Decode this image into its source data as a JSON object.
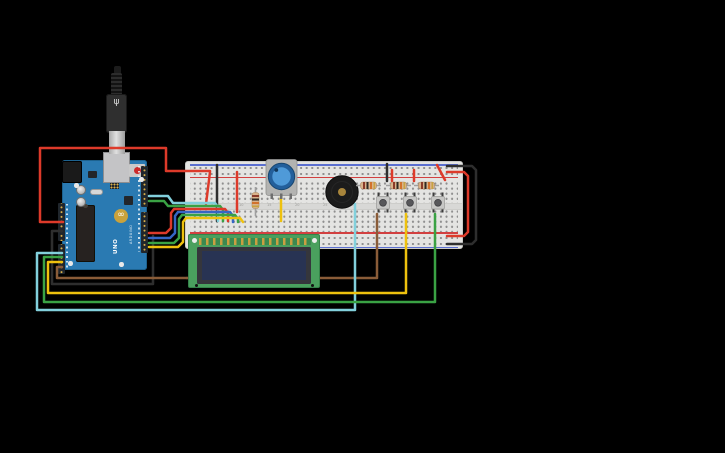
{
  "canvas": {
    "width": 725,
    "height": 453,
    "background": "#000000"
  },
  "palette": {
    "red": "#dd3a2a",
    "black": "#2e2e2e",
    "yellow": "#eec10e",
    "green": "#3aa244",
    "cyan": "#82d0dc",
    "blue": "#3566c4",
    "brown": "#8a5c38"
  },
  "arduino": {
    "label": "Arduino Uno R3",
    "logo": "∞",
    "brand": "ARDUINO",
    "model": "UNO"
  },
  "usb_symbol": "ψ",
  "breadboard": {
    "label": "Breadboard",
    "column_labels": [
      "5",
      "10",
      "15",
      "20",
      "25",
      "30",
      "35",
      "40",
      "45"
    ]
  },
  "lcd": {
    "label": "LCD 16x2"
  },
  "components": {
    "buzzer": "Piezo buzzer",
    "potentiometer": "Potentiometer",
    "buttons": [
      "Pushbutton 1",
      "Pushbutton 2",
      "Pushbutton 3"
    ],
    "resistors": [
      "Resistor 1",
      "Resistor 2",
      "Resistor 3",
      "Resistor 4"
    ],
    "usb_cable": "USB cable"
  },
  "wires": [
    {
      "name": "wire-5v-red",
      "color": "red",
      "layer": "over",
      "points": [
        [
          63,
          222
        ],
        [
          40,
          222
        ],
        [
          40,
          148
        ],
        [
          166,
          148
        ],
        [
          166,
          171
        ],
        [
          210,
          171
        ]
      ]
    },
    {
      "name": "wire-red-jumper-left-diagonal",
      "color": "red",
      "layer": "over",
      "points": [
        [
          210,
          172
        ],
        [
          206,
          204
        ]
      ]
    },
    {
      "name": "wire-red-jumper-col9",
      "color": "red",
      "layer": "over",
      "points": [
        [
          237,
          172
        ],
        [
          237,
          212
        ]
      ]
    },
    {
      "name": "wire-black-jumper-col5",
      "color": "black",
      "layer": "over",
      "points": [
        [
          217,
          165
        ],
        [
          217,
          221
        ]
      ]
    },
    {
      "name": "wire-gnd-black",
      "color": "black",
      "layer": "over",
      "points": [
        [
          62,
          231
        ],
        [
          52,
          231
        ],
        [
          52,
          284
        ],
        [
          153,
          284
        ],
        [
          153,
          236
        ]
      ]
    },
    {
      "name": "wire-cyan-a1-buzzer",
      "color": "cyan",
      "layer": "over",
      "points": [
        [
          62,
          253
        ],
        [
          37,
          253
        ],
        [
          37,
          310
        ],
        [
          355,
          310
        ],
        [
          355,
          204
        ]
      ]
    },
    {
      "name": "wire-green-a2-button3",
      "color": "green",
      "layer": "over",
      "points": [
        [
          62,
          257
        ],
        [
          44,
          257
        ],
        [
          44,
          302
        ],
        [
          435,
          302
        ],
        [
          435,
          214
        ]
      ]
    },
    {
      "name": "wire-yellow-a3-button2",
      "color": "yellow",
      "layer": "over",
      "points": [
        [
          62,
          262
        ],
        [
          48,
          262
        ],
        [
          48,
          293
        ],
        [
          406,
          293
        ],
        [
          406,
          214
        ]
      ]
    },
    {
      "name": "wire-brown-a4-segment-left",
      "color": "brown",
      "layer": "over",
      "points": [
        [
          62,
          267
        ],
        [
          57,
          267
        ],
        [
          57,
          278
        ],
        [
          187,
          278
        ]
      ]
    },
    {
      "name": "wire-brown-a4-segment-right",
      "color": "brown",
      "layer": "under",
      "points": [
        [
          187,
          278
        ],
        [
          377,
          278
        ],
        [
          377,
          214
        ]
      ]
    },
    {
      "name": "wire-d9-cyan",
      "color": "cyan",
      "layer": "over",
      "points": [
        [
          149,
          196
        ],
        [
          168,
          196
        ],
        [
          173,
          203
        ],
        [
          215,
          203
        ],
        [
          218,
          207
        ],
        [
          218,
          221
        ]
      ]
    },
    {
      "name": "wire-d8-green",
      "color": "green",
      "layer": "over",
      "points": [
        [
          149,
          201
        ],
        [
          164,
          201
        ],
        [
          168,
          206
        ],
        [
          220,
          206
        ],
        [
          223,
          210
        ],
        [
          223,
          221
        ]
      ]
    },
    {
      "name": "wire-d3-red",
      "color": "red",
      "layer": "over",
      "points": [
        [
          149,
          233
        ],
        [
          166,
          233
        ],
        [
          171,
          228
        ],
        [
          171,
          213
        ],
        [
          174,
          209
        ],
        [
          225,
          209
        ],
        [
          228,
          213
        ],
        [
          228,
          221
        ]
      ]
    },
    {
      "name": "wire-d2-blue",
      "color": "blue",
      "layer": "over",
      "points": [
        [
          149,
          238
        ],
        [
          170,
          238
        ],
        [
          175,
          233
        ],
        [
          175,
          216
        ],
        [
          178,
          212
        ],
        [
          230,
          212
        ],
        [
          233,
          216
        ],
        [
          233,
          222
        ]
      ]
    },
    {
      "name": "wire-d1-green",
      "color": "green",
      "layer": "over",
      "points": [
        [
          149,
          243
        ],
        [
          174,
          243
        ],
        [
          179,
          238
        ],
        [
          179,
          219
        ],
        [
          182,
          215
        ],
        [
          235,
          215
        ],
        [
          238,
          219
        ],
        [
          238,
          222
        ]
      ]
    },
    {
      "name": "wire-d0-yellow",
      "color": "yellow",
      "layer": "over",
      "points": [
        [
          149,
          247
        ],
        [
          178,
          247
        ],
        [
          183,
          242
        ],
        [
          183,
          222
        ],
        [
          186,
          218
        ],
        [
          240,
          218
        ],
        [
          243,
          222
        ]
      ]
    },
    {
      "name": "wire-pot-yellow",
      "color": "yellow",
      "layer": "over",
      "points": [
        [
          281,
          197
        ],
        [
          281,
          221
        ]
      ]
    },
    {
      "name": "wire-rail-red-right",
      "color": "red",
      "layer": "over",
      "points": [
        [
          447,
          172
        ],
        [
          464,
          172
        ],
        [
          468,
          176
        ],
        [
          468,
          232
        ],
        [
          464,
          236
        ],
        [
          447,
          236
        ]
      ]
    },
    {
      "name": "wire-rail-black-right",
      "color": "black",
      "layer": "over",
      "points": [
        [
          447,
          166
        ],
        [
          472,
          166
        ],
        [
          476,
          170
        ],
        [
          476,
          240
        ],
        [
          472,
          244
        ],
        [
          447,
          244
        ]
      ]
    },
    {
      "name": "wire-red-button1",
      "color": "red",
      "layer": "over",
      "points": [
        [
          392,
          170
        ],
        [
          392,
          181
        ]
      ]
    },
    {
      "name": "wire-red-button2",
      "color": "red",
      "layer": "over",
      "points": [
        [
          414,
          170
        ],
        [
          414,
          181
        ]
      ]
    },
    {
      "name": "wire-red-button3-diagonal",
      "color": "red",
      "layer": "over",
      "points": [
        [
          437,
          165
        ],
        [
          445,
          180
        ]
      ]
    },
    {
      "name": "wire-black-button1",
      "color": "black",
      "layer": "over",
      "points": [
        [
          387,
          164
        ],
        [
          387,
          181
        ]
      ]
    }
  ]
}
